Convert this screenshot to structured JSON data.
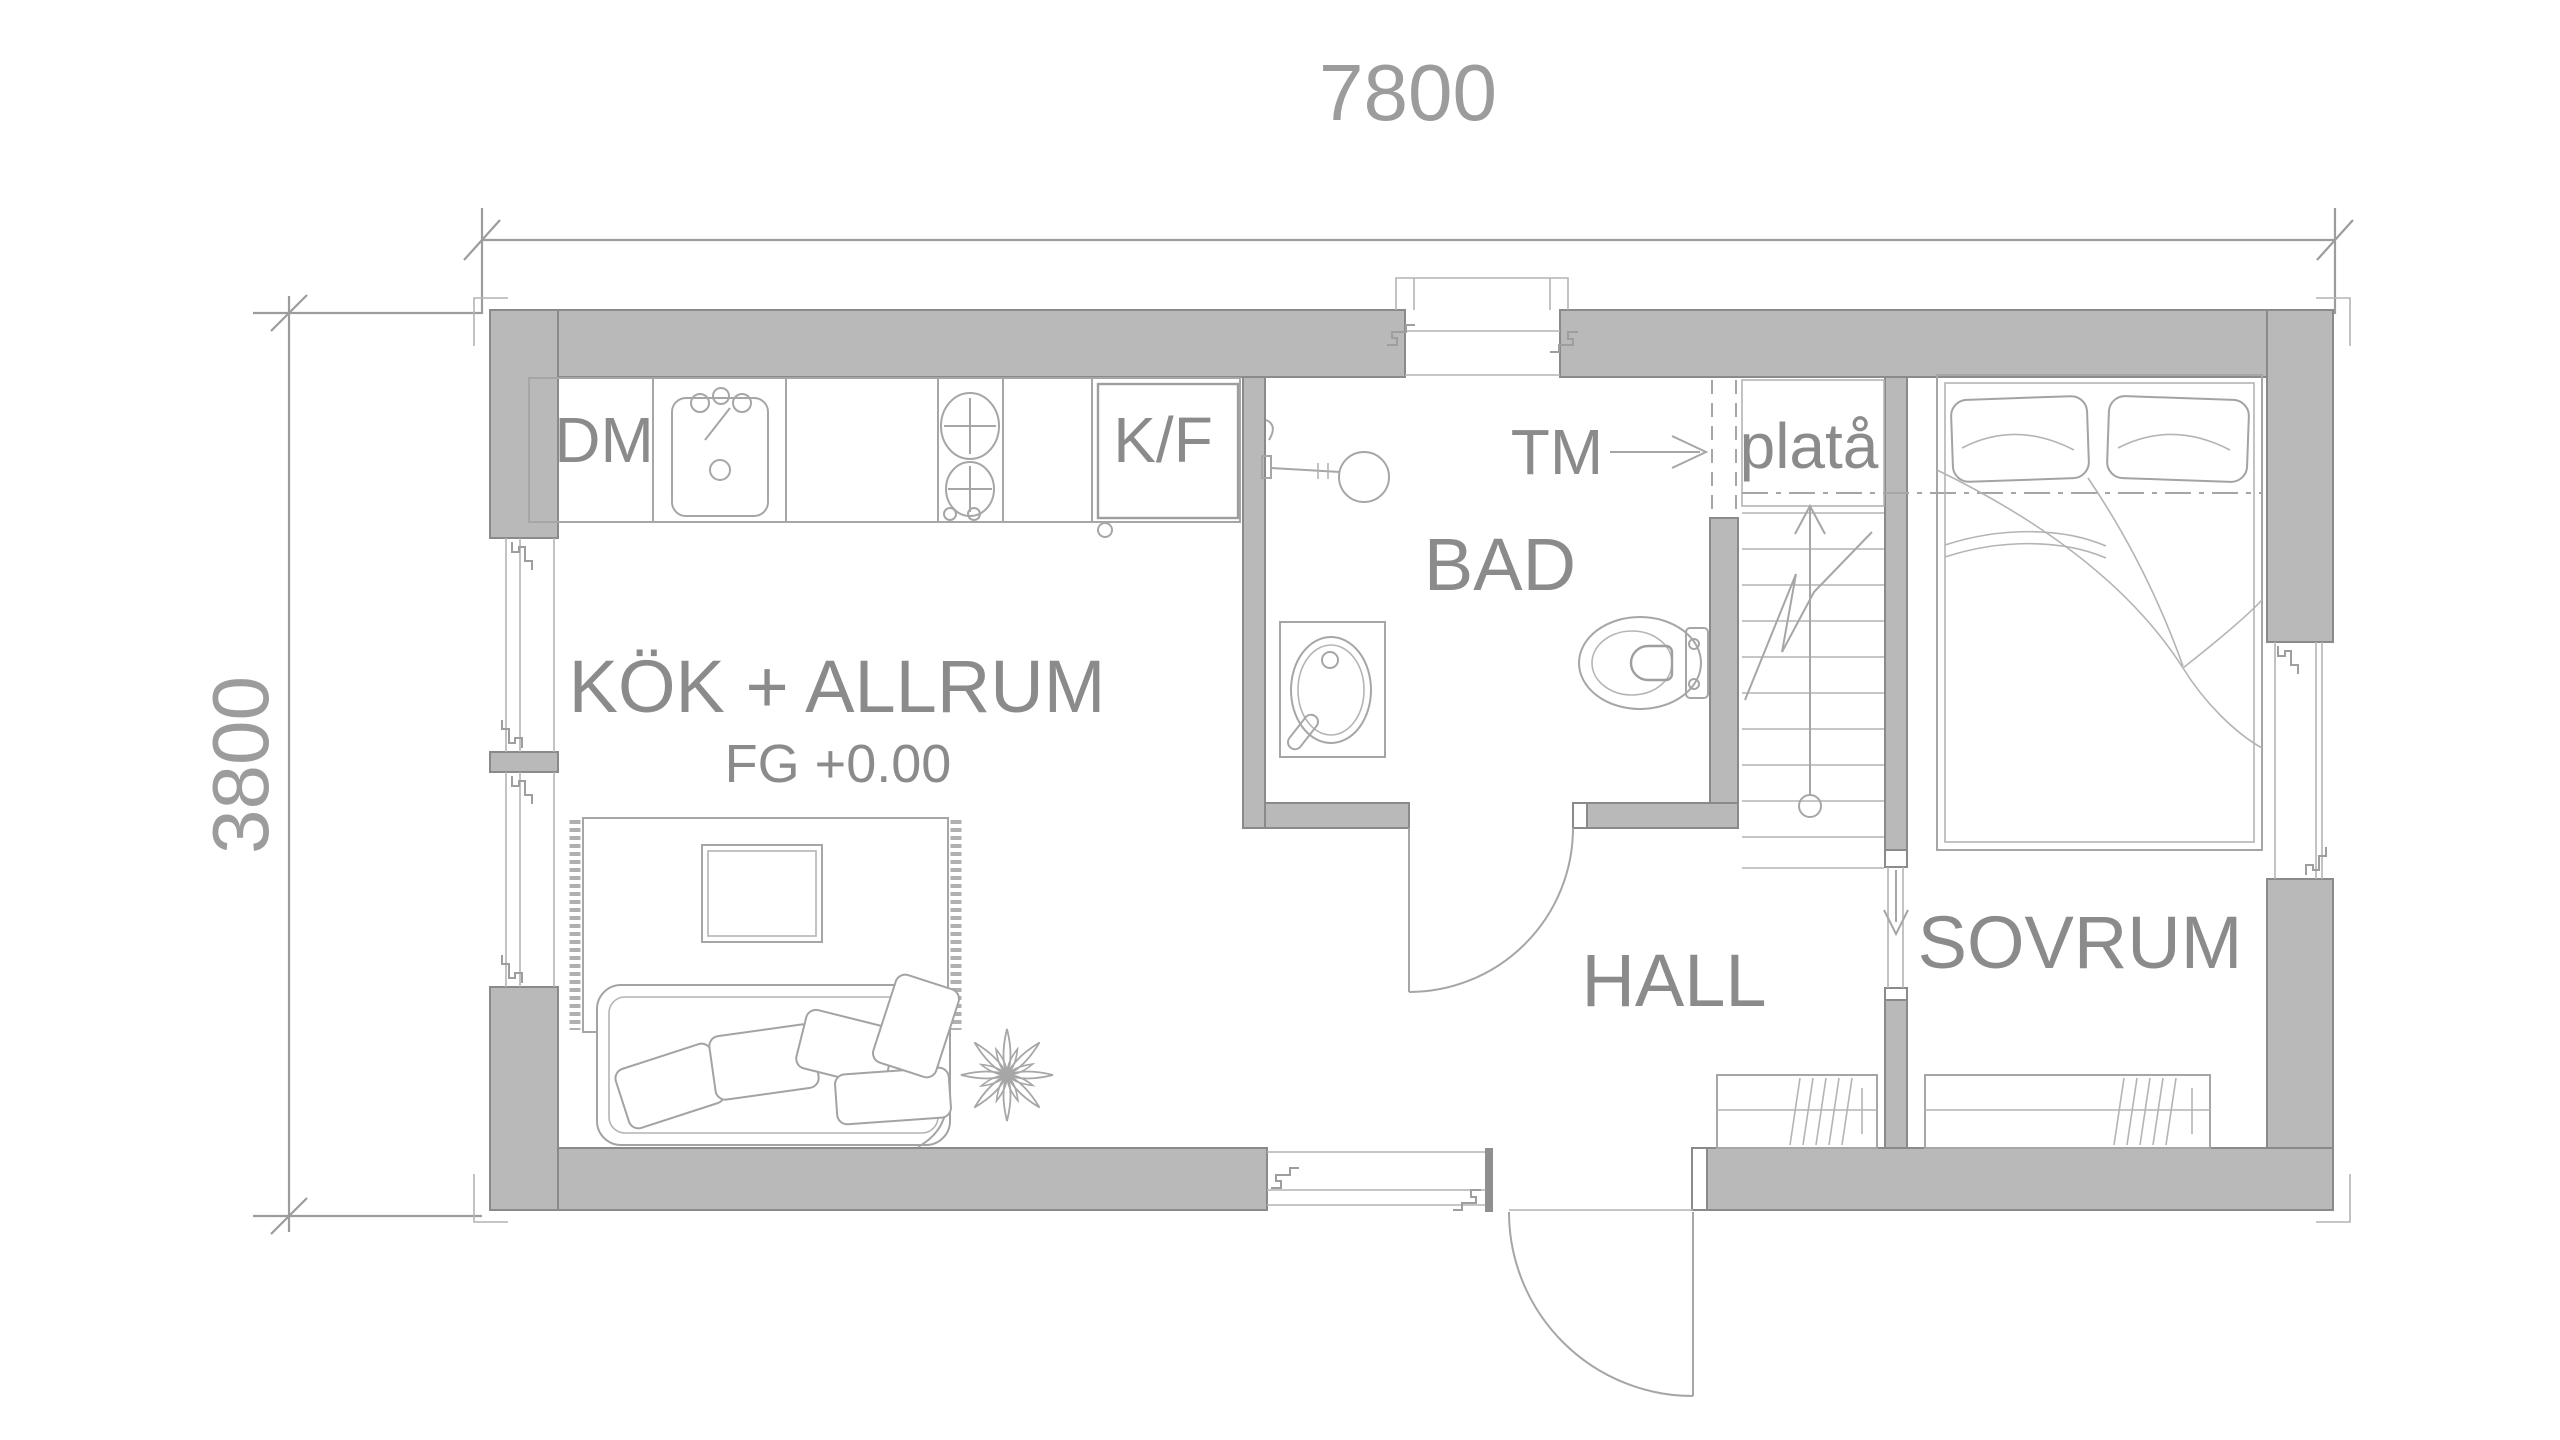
{
  "drawing": {
    "kind": "architectural floor plan",
    "dimensions": {
      "width_mm": "7800",
      "depth_mm": "3800"
    },
    "rooms": {
      "kitchen_living": {
        "label": "KÖK + ALLRUM",
        "floor_level": "FG +0.00"
      },
      "bathroom": {
        "label": "BAD"
      },
      "hall": {
        "label": "HALL"
      },
      "bedroom": {
        "label": "SOVRUM"
      },
      "stair_landing": {
        "label": "platå"
      }
    },
    "appliances": {
      "dishwasher": {
        "label": "DM"
      },
      "fridge_freezer": {
        "label": "K/F"
      },
      "washing_machine": {
        "label": "TM"
      }
    },
    "colors": {
      "background": "#ffffff",
      "wall_fill": "#b9b9b9",
      "wall_outline": "#8a8a8a",
      "furniture_line": "#a6a6a6",
      "label_text": "#8b8b8b",
      "dimension": "#9c9c9c"
    }
  }
}
